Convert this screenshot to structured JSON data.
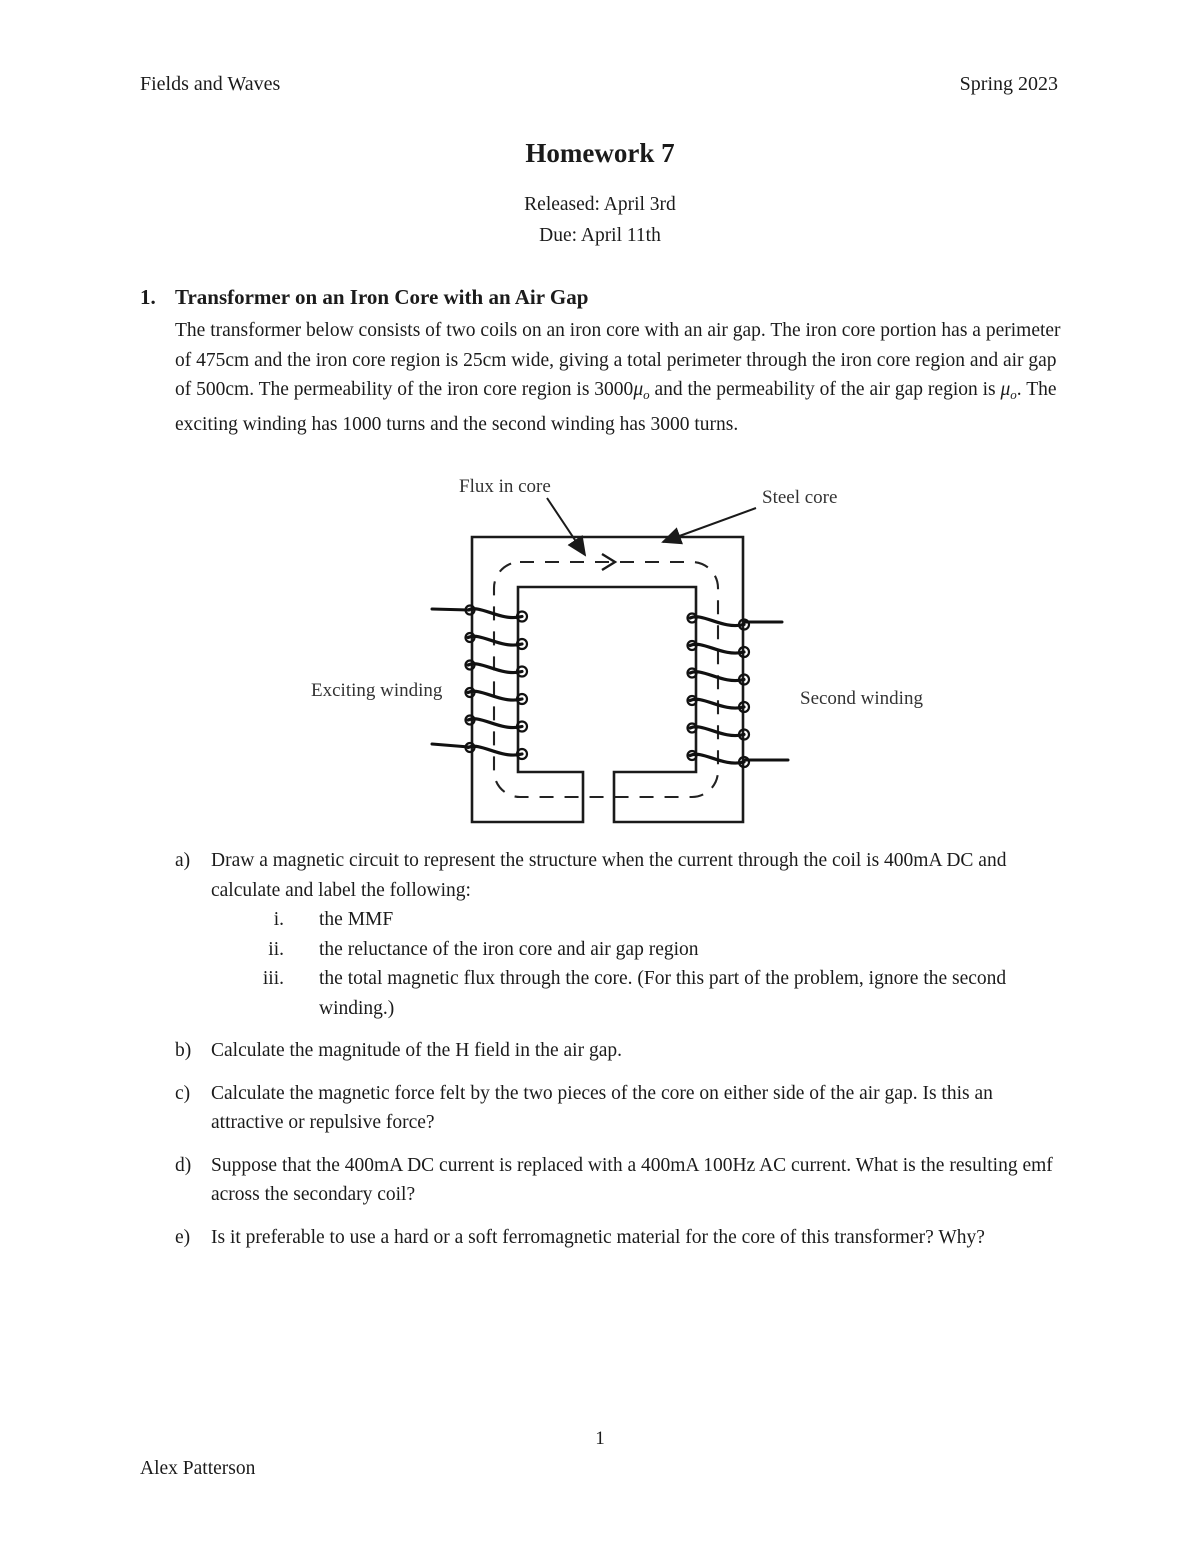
{
  "page": {
    "header_left": "Fields and Waves",
    "header_right": "Spring 2023",
    "title": "Homework 7",
    "released": "Released: April 3rd",
    "due": "Due: April 11th",
    "page_number": "1",
    "author": "Alex Patterson"
  },
  "section": {
    "number": "1.",
    "title": "Transformer on an Iron Core with an Air Gap"
  },
  "intro": {
    "seg_a": "The transformer below consists of two coils on an iron core with an air gap. The iron core portion has a perimeter of 475cm and the iron core region is 25cm wide, giving a total perimeter through the iron core region and air gap of 500cm. The permeability of the iron core region is 3000",
    "mu": "μ",
    "mu_sub": "o",
    "seg_b": " and the permeability of the air gap region is ",
    "seg_c": ". The exciting winding has 1000 turns and the second winding has 3000 turns."
  },
  "diagram": {
    "label_flux": "Flux in core",
    "label_steel": "Steel core",
    "label_exciting": "Exciting winding",
    "label_second": "Second winding",
    "line_color": "#1a1a1a"
  },
  "questions": [
    {
      "label": "a)",
      "text": "Draw a magnetic circuit to represent the structure when the current through the coil is 400mA DC and calculate and label the following:",
      "subitems": [
        {
          "label": "i.",
          "text": "the MMF"
        },
        {
          "label": "ii.",
          "text": "the reluctance of the iron core and air gap region"
        },
        {
          "label": "iii.",
          "text": "the total magnetic flux through the core. (For this part of the problem, ignore the second winding.)"
        }
      ]
    },
    {
      "label": "b)",
      "text": "Calculate the magnitude of the H field in the air gap."
    },
    {
      "label": "c)",
      "text": "Calculate the magnetic force felt by the two pieces of the core on either side of the air gap. Is this an attractive or repulsive force?"
    },
    {
      "label": "d)",
      "text": "Suppose that the 400mA DC current is replaced with a 400mA 100Hz AC current. What is the resulting emf across the secondary coil?"
    },
    {
      "label": "e)",
      "text": "Is it preferable to use a hard or a soft ferromagnetic material for the core of this transformer? Why?"
    }
  ]
}
